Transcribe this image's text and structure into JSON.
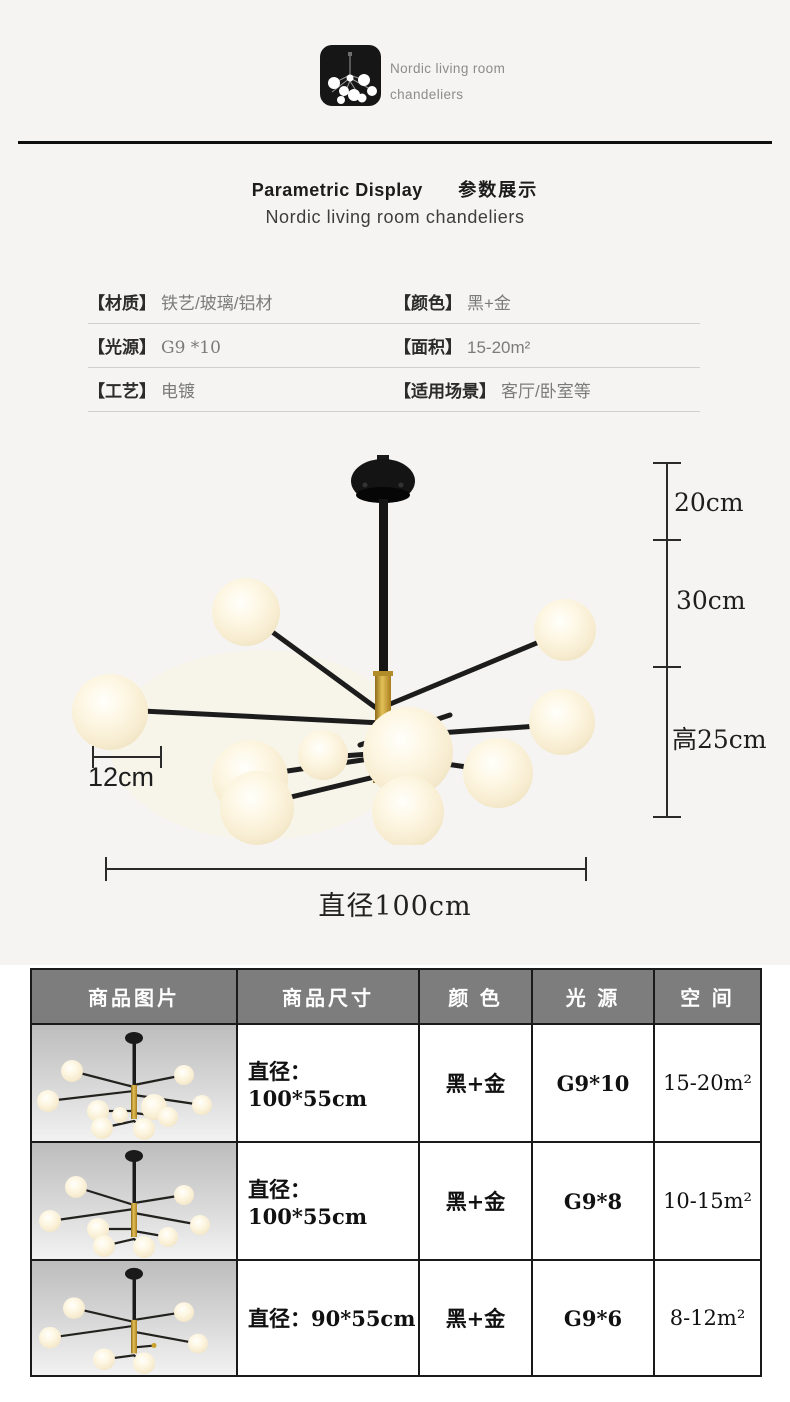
{
  "colors": {
    "gold": "#c9a22a",
    "ink": "#161616",
    "header_gray": "#7d7d7d",
    "page_bg": "#f5f4f2",
    "value_gray": "#7b7b7b",
    "line_gray": "#cfcfcf"
  },
  "brand": {
    "line1": "Nordic living room",
    "line2": "chandeliers"
  },
  "title": {
    "en": "Parametric Display",
    "zh": "参数展示",
    "subtitle": "Nordic living room chandeliers"
  },
  "params": [
    {
      "label": "【材质】",
      "value": "铁艺/玻璃/铝材"
    },
    {
      "label": "【颜色】",
      "value": "黑+金"
    },
    {
      "label": "【光源】",
      "value": "G9 *10"
    },
    {
      "label": "【面积】",
      "value": "15-20m²"
    },
    {
      "label": "【工艺】",
      "value": "电镀"
    },
    {
      "label": "【适用场景】",
      "value": "客厅/卧室等"
    }
  ],
  "figure": {
    "dims": {
      "top_rod": "20cm",
      "mid_rod": "30cm",
      "body_height": "高25cm",
      "globe": "12cm",
      "diameter": "直径100cm"
    }
  },
  "spec_table": {
    "headers": [
      "商品图片",
      "商品尺寸",
      "颜 色",
      "光 源",
      "空 间"
    ],
    "rows": [
      {
        "size": "直径：100*55cm",
        "color": "黑+金",
        "light": "G9*10",
        "space": "15-20m²"
      },
      {
        "size": "直径：100*55cm",
        "color": "黑+金",
        "light": "G9*8",
        "space": "10-15m²"
      },
      {
        "size": "直径：90*55cm",
        "color": "黑+金",
        "light": "G9*6",
        "space": "8-12m²"
      }
    ]
  }
}
